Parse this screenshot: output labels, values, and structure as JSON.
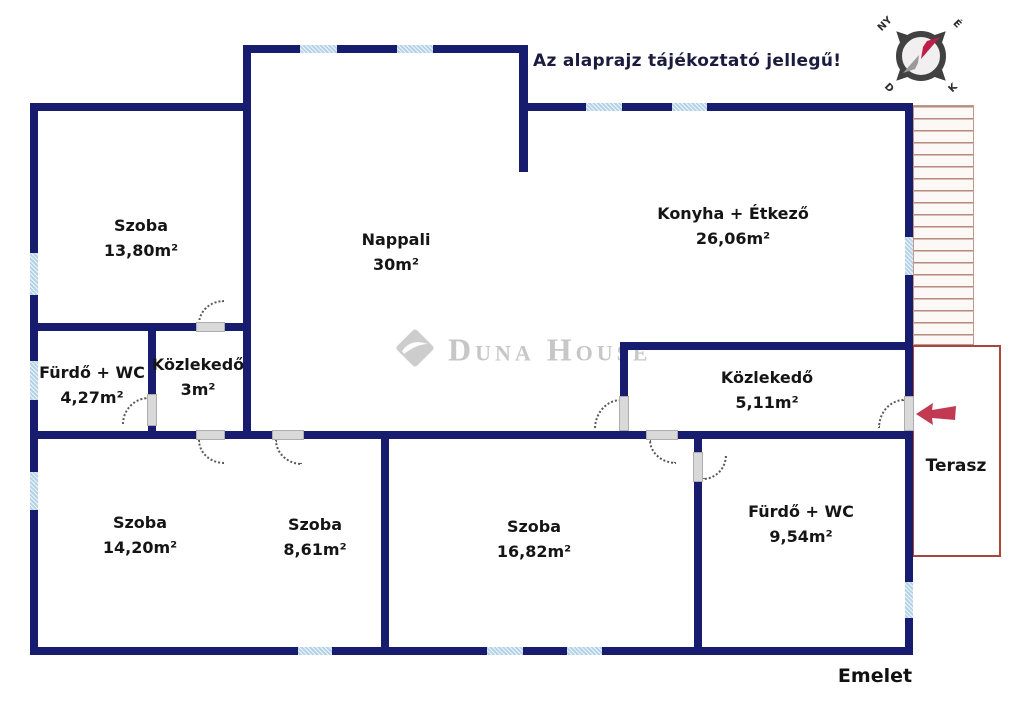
{
  "meta": {
    "title": "Az alaprajz tájékoztató jellegű!",
    "floor_label": "Emelet"
  },
  "watermark": {
    "brand": "Duna House",
    "registered": "®"
  },
  "compass": {
    "n": "É",
    "e": "K",
    "s": "D",
    "w": "NY"
  },
  "terrace": {
    "label": "Terasz"
  },
  "rooms": [
    {
      "id": "szoba-felso",
      "name": "Szoba",
      "area": "13,80m²"
    },
    {
      "id": "nappali",
      "name": "Nappali",
      "area": "30m²"
    },
    {
      "id": "konyha-etkezo",
      "name": "Konyha + Étkező",
      "area": "26,06m²"
    },
    {
      "id": "furdo-wc-kis",
      "name": "Fürdő + WC",
      "area": "4,27m²"
    },
    {
      "id": "kozlekedo-kis",
      "name": "Közlekedő",
      "area": "3m²"
    },
    {
      "id": "kozlekedo-nagy",
      "name": "Közlekedő",
      "area": "5,11m²"
    },
    {
      "id": "szoba-balalso",
      "name": "Szoba",
      "area": "14,20m²"
    },
    {
      "id": "szoba-kozepso",
      "name": "Szoba",
      "area": "8,61m²"
    },
    {
      "id": "szoba-also",
      "name": "Szoba",
      "area": "16,82m²"
    },
    {
      "id": "furdo-wc-nagy",
      "name": "Fürdő + WC",
      "area": "9,54m²"
    }
  ],
  "colors": {
    "wall": "#171c6e",
    "window": "#b5d3e8",
    "terrace_border": "#a8463b",
    "stairs_line": "#b6897b",
    "entry_arrow": "#c23a52",
    "compass_needle": "#bf1e4b",
    "watermark": "#c7c7c7"
  }
}
